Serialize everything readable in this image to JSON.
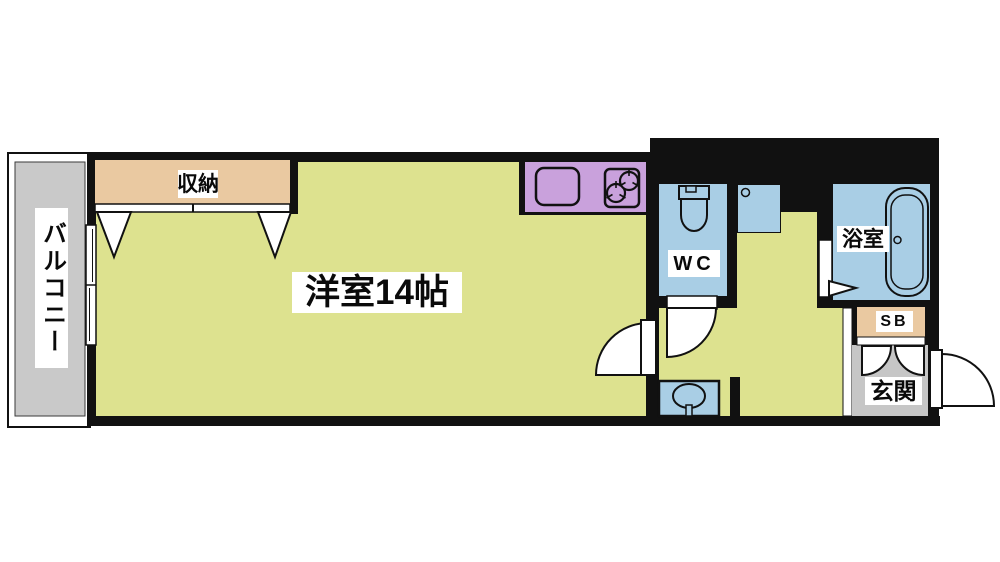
{
  "floor_plan": {
    "labels": {
      "balcony": "バルコニー",
      "closet": "収納",
      "main_room": "洋室14帖",
      "wc": "WC",
      "bathroom": "浴室",
      "shoe_box": "SB",
      "entrance": "玄関"
    },
    "colors": {
      "wall": "#111111",
      "floor_main": "#dde28f",
      "closet": "#eac9a1",
      "kitchen": "#c9a1dc",
      "wet_area": "#a9cee5",
      "balcony": "#c9c9c9",
      "entrance_floor": "#c6c6c6",
      "fixture_line": "#111111",
      "background": "#ffffff"
    }
  }
}
